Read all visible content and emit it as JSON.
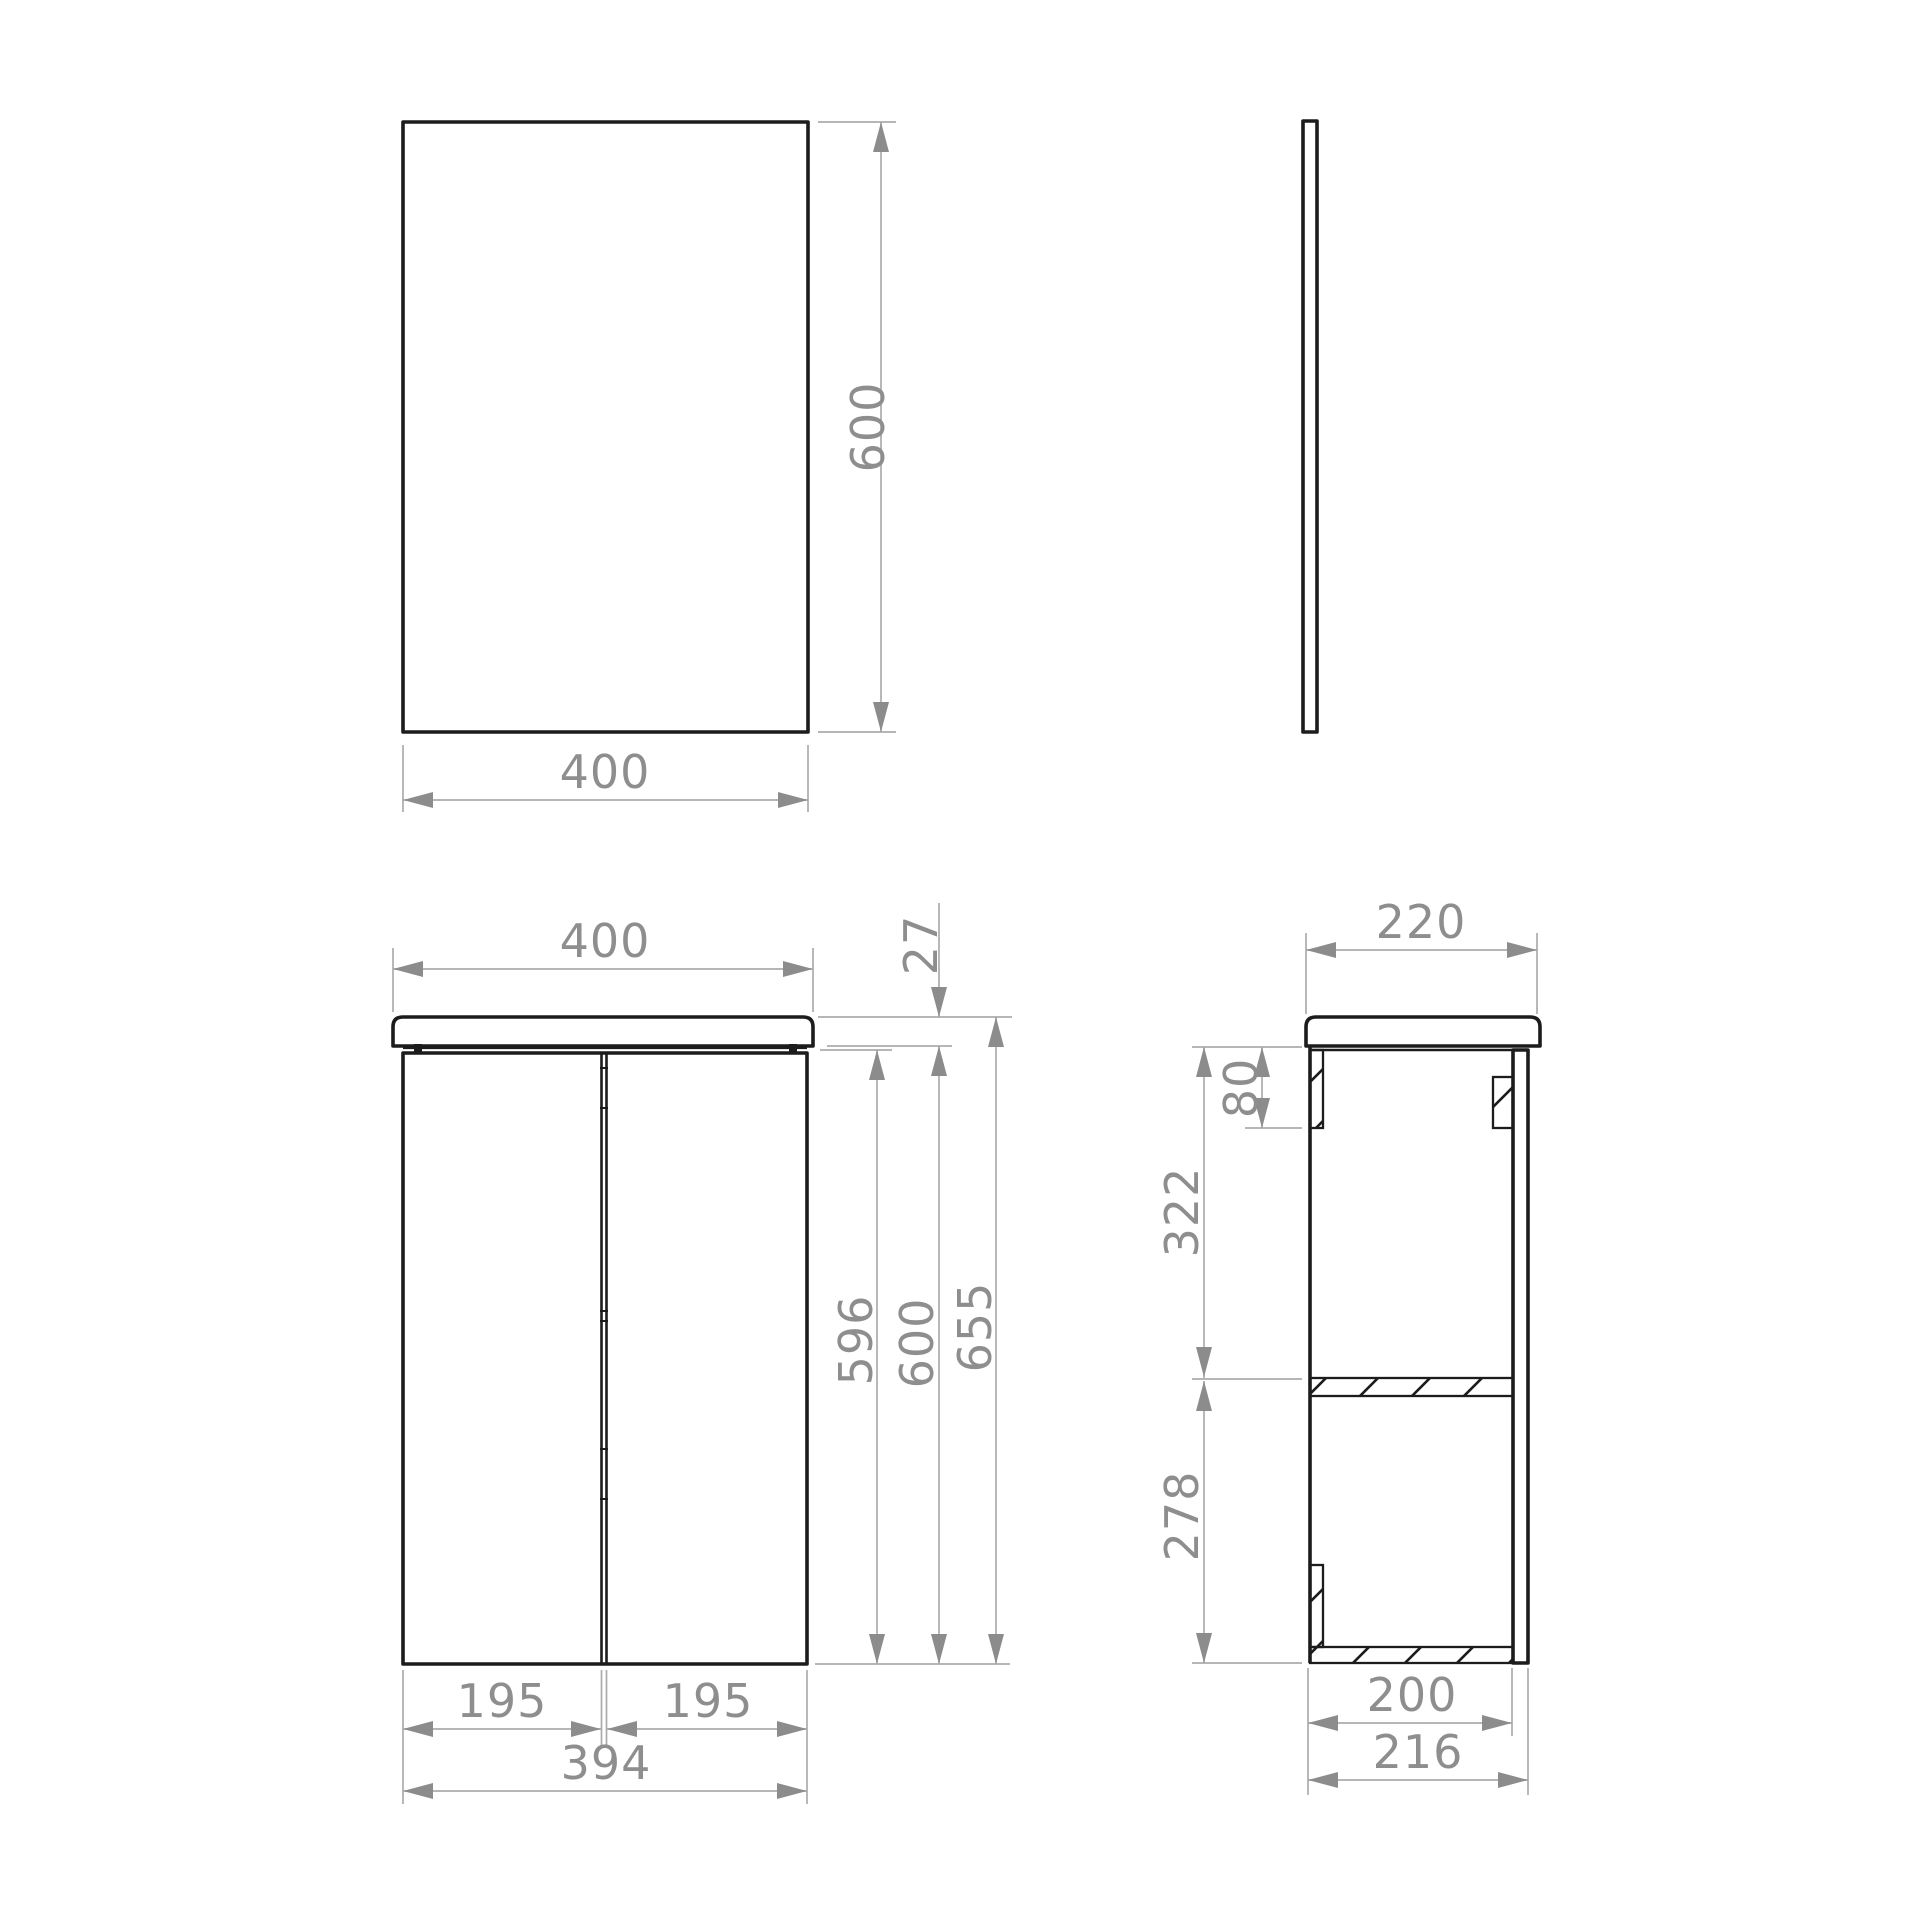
{
  "page": {
    "description": "Technical dimension drawing (mm) of a bathroom wall cabinet with worktop and a separate mirror panel: mirror front and side views on top, cabinet front and side views below.",
    "units": "mm"
  },
  "views": {
    "mirror_front": {
      "label": "mirror front view",
      "width": "400",
      "height": "600"
    },
    "mirror_side": {
      "label": "mirror side view"
    },
    "cabinet_front": {
      "label": "cabinet front view",
      "worktop_width": "400",
      "worktop_thickness": "27",
      "door_height": "596",
      "carcass_height": "600",
      "overall_height": "655",
      "left_door_width": "195",
      "right_door_width": "195",
      "doors_overall_width": "394"
    },
    "cabinet_side": {
      "label": "cabinet side view",
      "worktop_depth": "220",
      "hanging_rail_height": "80",
      "upper_compartment_height": "322",
      "lower_compartment_height": "278",
      "carcass_depth": "200",
      "overall_depth": "216"
    }
  },
  "colors": {
    "outline": "#1c1c1c",
    "dimension_line": "#ababab",
    "arrow": "#8c8c8c",
    "dimension_text": "#8e8e8e",
    "background": "#ffffff"
  }
}
